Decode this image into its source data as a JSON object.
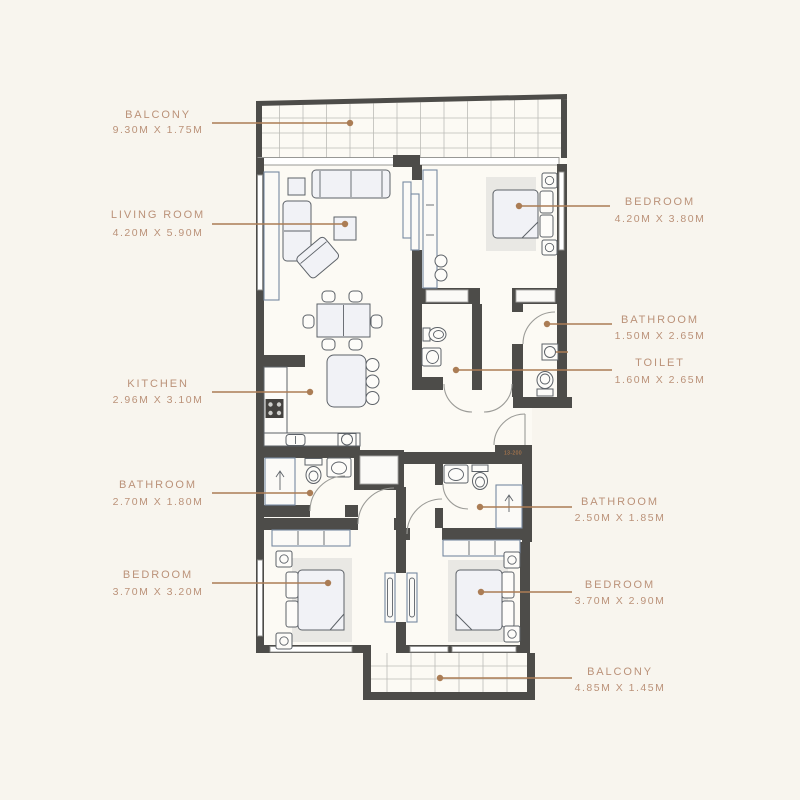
{
  "entrance_tag": "13-200",
  "colors": {
    "background": "#f8f5ee",
    "floor": "#fcfaf4",
    "wall": "#4d4c49",
    "window_stroke": "#8d8d8b",
    "furniture_fill": "#f1f2f6",
    "furniture_stroke": "#5d6268",
    "fixture_stroke": "#7789a1",
    "rug": "#e9e8e4",
    "grid_line": "#bcbcb7",
    "door_arc": "#9b9b97",
    "leader": "#ab7d55",
    "label_text": "#bb9279",
    "tag": "#c9854e"
  },
  "rooms": [
    {
      "name": "BALCONY",
      "dimensions": "9.30M X 1.75M"
    },
    {
      "name": "LIVING ROOM",
      "dimensions": "4.20M X 5.90M"
    },
    {
      "name": "KITCHEN",
      "dimensions": "2.96M X 3.10M"
    },
    {
      "name": "BATHROOM",
      "dimensions": "2.70M X 1.80M"
    },
    {
      "name": "BEDROOM",
      "dimensions": "3.70M X 3.20M"
    },
    {
      "name": "BEDROOM",
      "dimensions": "4.20M X 3.80M"
    },
    {
      "name": "BATHROOM",
      "dimensions": "1.50M X 2.65M"
    },
    {
      "name": "TOILET",
      "dimensions": "1.60M X 2.65M"
    },
    {
      "name": "BATHROOM",
      "dimensions": "2.50M X 1.85M"
    },
    {
      "name": "BEDROOM",
      "dimensions": "3.70M X 2.90M"
    },
    {
      "name": "BALCONY",
      "dimensions": "4.85M X 1.45M"
    }
  ]
}
